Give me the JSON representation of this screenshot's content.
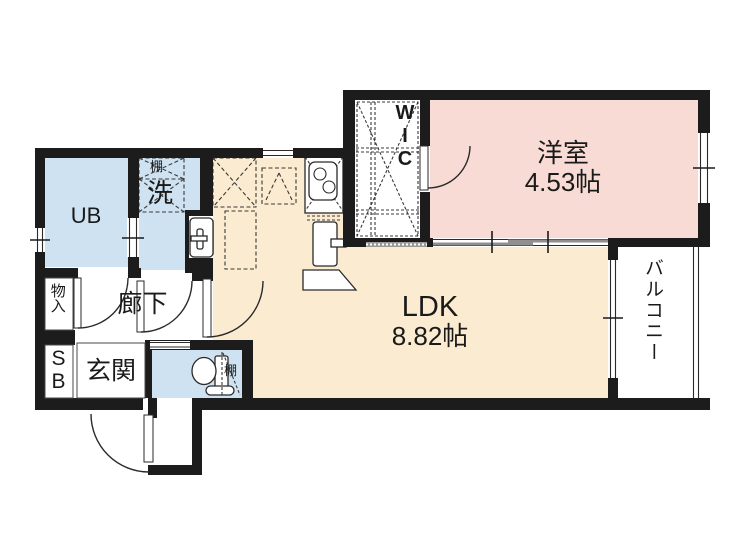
{
  "floorplan": {
    "rooms": {
      "unit_bath": {
        "label": "UB"
      },
      "laundry": {
        "label": "洗",
        "shelf_label": "棚"
      },
      "walk_in_closet": {
        "label": "WIC"
      },
      "western_room": {
        "label": "洋室",
        "size": "4.53帖"
      },
      "ldk": {
        "label": "LDK",
        "size": "8.82帖"
      },
      "balcony": {
        "label": "バルコニー"
      },
      "hallway": {
        "label": "廊下"
      },
      "storage": {
        "label": "物入"
      },
      "shoe_box": {
        "label": "SB"
      },
      "entrance": {
        "label": "玄関"
      },
      "toilet": {
        "shelf_label": "棚"
      }
    },
    "colors": {
      "wall": "#1c1c1c",
      "wet_area_floor": "#cfe2f1",
      "ldk_floor": "#fbebd0",
      "bedroom_floor": "#f8dbd5",
      "background": "#ffffff"
    }
  }
}
